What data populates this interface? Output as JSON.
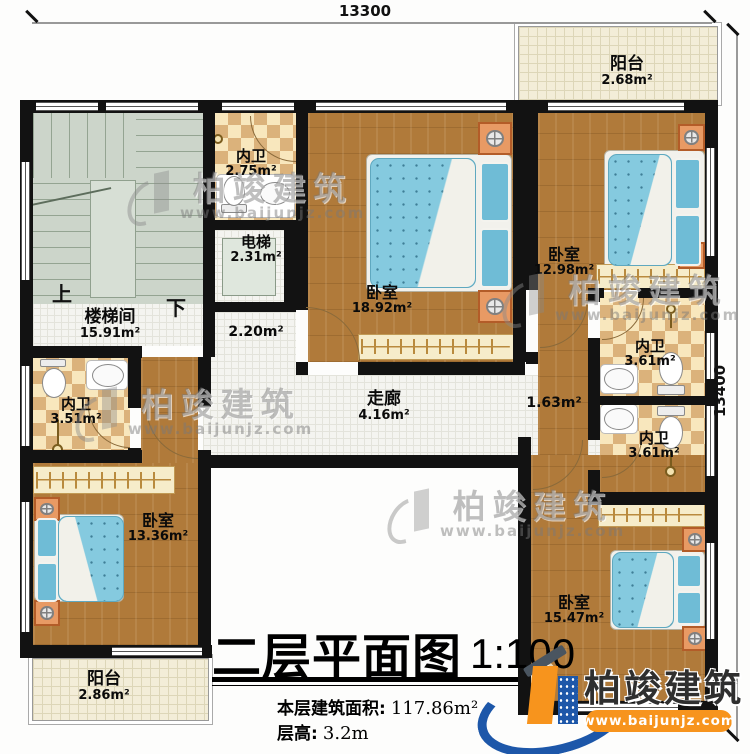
{
  "dimensions": {
    "top": "13300",
    "right": "13400"
  },
  "stairs": {
    "up": "上",
    "down": "下"
  },
  "rooms": {
    "stairwell": {
      "name": "楼梯间",
      "area": "15.91m²"
    },
    "bath_top": {
      "name": "内卫",
      "area": "2.75m²"
    },
    "elevator": {
      "name": "电梯",
      "area": "2.31m²"
    },
    "hall_small": {
      "area": "2.20m²"
    },
    "bedroom_center": {
      "name": "卧室",
      "area": "18.92m²"
    },
    "balcony_top": {
      "name": "阳台",
      "area": "2.68m²"
    },
    "bedroom_topright": {
      "name": "卧室",
      "area": "12.98m²"
    },
    "bath_right_upper": {
      "name": "内卫",
      "area": "3.61m²"
    },
    "bath_right_lower": {
      "name": "内卫",
      "area": "3.61m²"
    },
    "corridor": {
      "name": "走廊",
      "area": "4.16m²"
    },
    "hall_right": {
      "area": "1.63m²"
    },
    "bath_left": {
      "name": "内卫",
      "area": "3.51m²"
    },
    "bedroom_bottomleft": {
      "name": "卧室",
      "area": "13.36m²"
    },
    "balcony_bottom": {
      "name": "阳台",
      "area": "2.86m²"
    },
    "bedroom_bottomright": {
      "name": "卧室",
      "area": "15.47m²"
    }
  },
  "title": {
    "main": "二层平面图",
    "scale": "1:100",
    "area_label": "本层建筑面积:",
    "area_value": "117.86m²",
    "height_label": "层高:",
    "height_value": "3.2m"
  },
  "watermark": {
    "brand": "柏竣建筑",
    "url": "www.baijunjz.com"
  },
  "logo": {
    "brand": "柏竣建筑",
    "url": "www.baijunjz.com"
  },
  "colors": {
    "wall": "#121212",
    "wood": "#b07a3a",
    "tile_light": "#f8e7bd",
    "tile_dark": "#dbb27b",
    "brand_blue": "#1d57a9",
    "brand_orange": "#f7941d"
  }
}
